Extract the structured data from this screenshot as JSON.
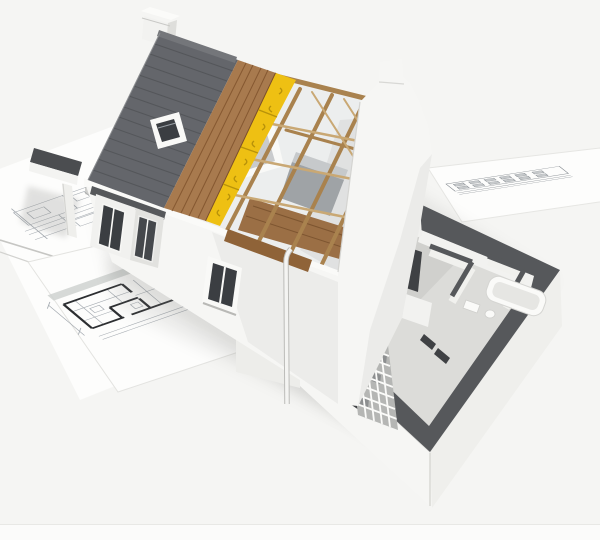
{
  "meta": {
    "type": "3d-architectural-render",
    "description": "Cutaway 3D model of a house under construction, roof layers peeled back (shingles, wood sheathing, insulation, open rafters), standing on architectural blueprint sheets",
    "width": 600,
    "height": 540
  },
  "palette": {
    "background": "#f5f5f3",
    "bottom_strip": "#fbfbfa",
    "paper": "#fdfdfc",
    "paper_line": "#a4aab0",
    "paper_edge": "#d5d5d2",
    "plan_wall": "#2c2e31",
    "shingle": "#64666b",
    "shingle_line": "#515357",
    "ridge_cap": "#74767a",
    "sheathing": "#a87a4e",
    "sheathing_line": "#855831",
    "attic_floor": "#9b6f45",
    "attic_floor_edge": "#7d5530",
    "insulation": "#eec013",
    "insulation_shade": "#b8920a",
    "timber": "#a9824e",
    "timber_light": "#c9a874",
    "wall_white": "#f6f6f4",
    "wall_shade": "#e2e2df",
    "wall_top": "#56585b",
    "roof_dark": "#4b4d50",
    "window_glass": "#3b3e42",
    "frame_white": "#f9f9f7",
    "floor_interior": "#dcdcd9",
    "interior_backdrop": "#eceeee",
    "furniture": "#9fa3a6",
    "furniture_top": "#c6c9cb",
    "counter_dark": "#46484b",
    "appliance_dark": "#3f4144",
    "block_wall": "#b5b6b4",
    "block_joint": "#fbfbf9",
    "block_dark_cell": "#8d8f90",
    "fixture_white": "#fafaf8",
    "shadow": "#7e7e7a"
  },
  "scene": {
    "house": {
      "roof_layers": [
        "asphalt-shingles",
        "wood-sheathing",
        "yellow-insulation",
        "battens",
        "open-rafters"
      ],
      "features": [
        "chimney",
        "skylight-window",
        "attic-window",
        "right-gable-wall",
        "front-wall",
        "front-window",
        "bay-windows",
        "porch",
        "downpipe",
        "attic-bed",
        "attic-floor",
        "ridge-beam"
      ]
    },
    "ground_floor_wing": {
      "features": [
        "cutaway-perimeter-walls",
        "interior-floor",
        "kitchen-counter",
        "tall-appliance",
        "masonry-block-section",
        "bathtub",
        "toilet",
        "sink",
        "interior-partitions",
        "outer-white-walls"
      ]
    },
    "blueprints": [
      "left-plan-sheet",
      "bottom-floor-plan-sheet",
      "right-elevation-sheet"
    ]
  }
}
